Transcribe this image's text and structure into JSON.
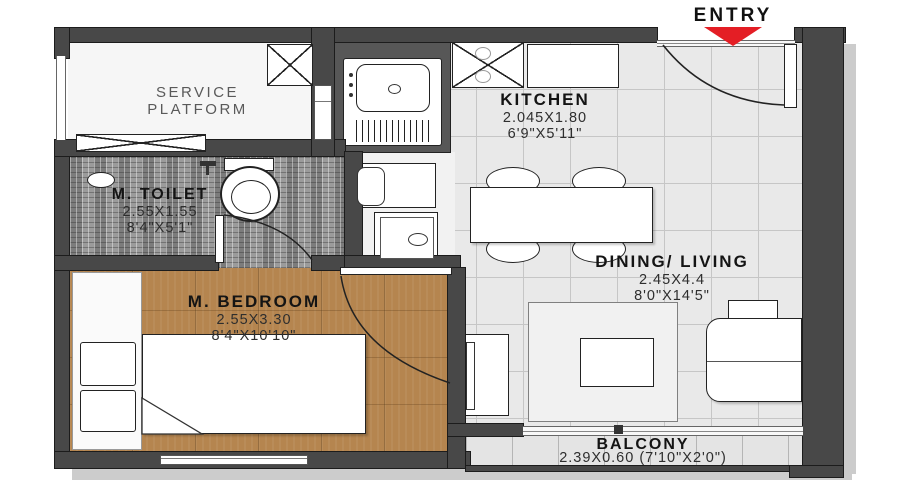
{
  "entry": {
    "label": "ENTRY"
  },
  "rooms": {
    "service_platform": {
      "name": "SERVICE PLATFORM"
    },
    "kitchen": {
      "name": "KITCHEN",
      "dim_m": "2.045X1.80",
      "dim_ft": "6'9\"X5'11\""
    },
    "m_toilet": {
      "name": "M. TOILET",
      "dim_m": "2.55X1.55",
      "dim_ft": "8'4\"X5'1\""
    },
    "m_bedroom": {
      "name": "M. BEDROOM",
      "dim_m": "2.55X3.30",
      "dim_ft": "8'4\"X10'10\""
    },
    "dining_living": {
      "name": "DINING/ LIVING",
      "dim_m": "2.45X4.4",
      "dim_ft": "8'0\"X14'5\""
    },
    "balcony": {
      "name": "BALCONY",
      "dim": "2.39X0.60 (7'10\"X2'0\")"
    }
  },
  "colors": {
    "wall": "#484848",
    "entry_arrow": "#e41e25",
    "wood_floor": "#b5854f",
    "tile_floor": "#e9e9e9",
    "toilet_floor": "#909090"
  }
}
